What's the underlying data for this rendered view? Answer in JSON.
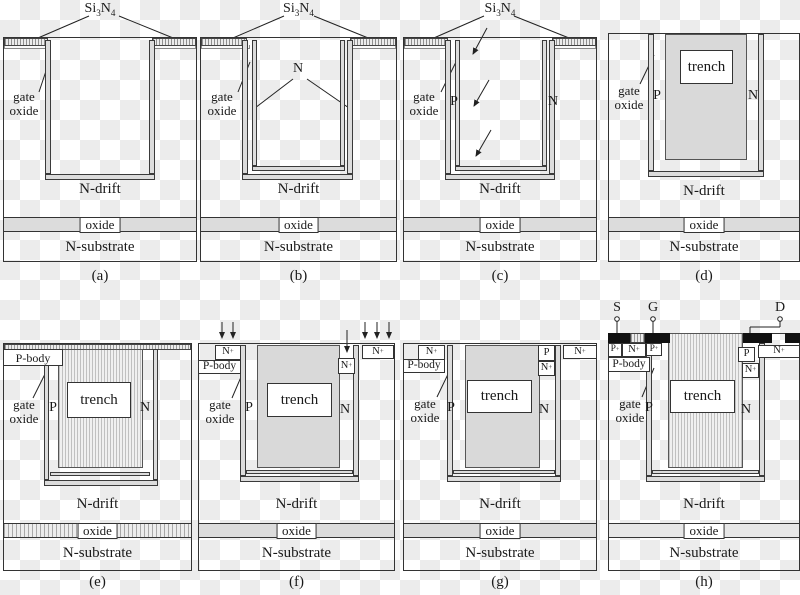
{
  "figure": {
    "description": "trench MOSFET process flow cross-sections",
    "checker_light": "#ffffff",
    "checker_dark": "#ececec"
  },
  "colors": {
    "line": "#333333",
    "liner_fill": "#dcdcdc",
    "trench_fill": "#d9d9d9",
    "oxide_band": "#dcdcdc",
    "metal": "#111111"
  },
  "labels": {
    "si3n4": {
      "s1": "Si",
      "s2": "3",
      "s3": "N",
      "s4": "4"
    },
    "gate_oxide": {
      "l1": "gate",
      "l2": "oxide"
    },
    "n_drift": "N-drift",
    "oxide": "oxide",
    "n_substrate": "N-substrate",
    "trench": "trench",
    "p": "P",
    "n": "N",
    "p_body": "P-body",
    "n_plus": {
      "b": "N",
      "s": "+"
    },
    "p_plus": {
      "b": "P",
      "s": "+"
    },
    "s": "S",
    "g": "G",
    "d": "D"
  },
  "captions": {
    "a": "(a)",
    "b": "(b)",
    "c": "(c)",
    "d": "(d)",
    "e": "(e)",
    "f": "(f)",
    "g": "(g)",
    "h": "(h)"
  }
}
